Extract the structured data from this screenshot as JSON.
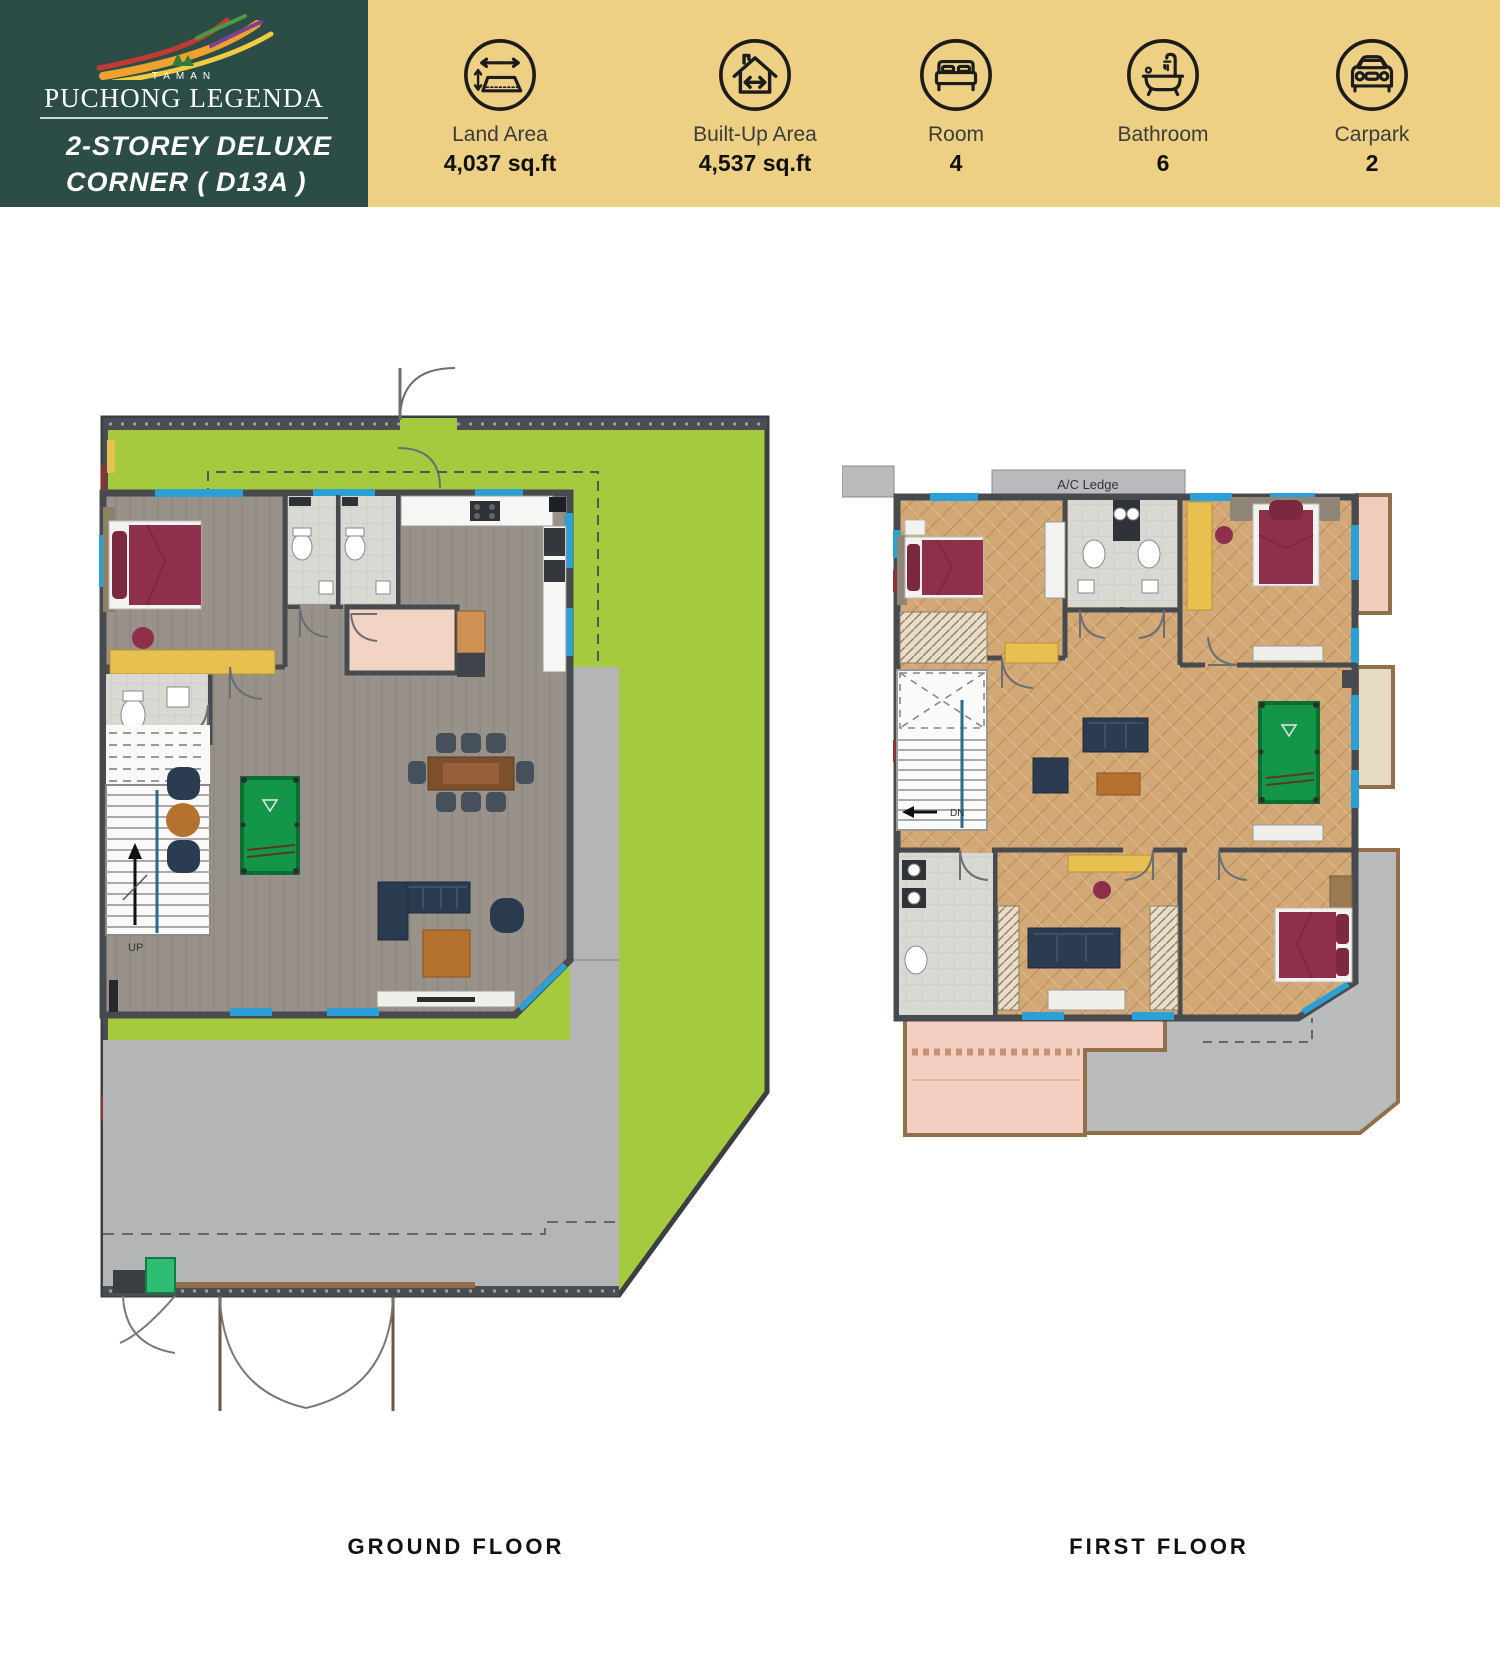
{
  "header": {
    "logo": {
      "tagline": "TAMAN",
      "brand": "PUCHONG LEGENDA"
    },
    "title_line1": "2-STOREY DELUXE",
    "title_line2": "CORNER ( D13A )",
    "stats": [
      {
        "icon": "land-area-icon",
        "label": "Land Area",
        "value": "4,037 sq.ft"
      },
      {
        "icon": "built-up-area-icon",
        "label": "Built-Up Area",
        "value": "4,537 sq.ft"
      },
      {
        "icon": "bed-icon",
        "label": "Room",
        "value": "4"
      },
      {
        "icon": "bathtub-icon",
        "label": "Bathroom",
        "value": "6"
      },
      {
        "icon": "car-icon",
        "label": "Carpark",
        "value": "2"
      }
    ]
  },
  "colors": {
    "header_panel": "#2b4d45",
    "banner": "#edd083",
    "lawn": "#a5ca3e",
    "wall": "#474b4f",
    "driveway": "#b3b5b7",
    "window_blue": "#2aa0d6",
    "accent_maroon": "#8e2f4b",
    "pool_green": "#14964a"
  },
  "plans": {
    "ground": {
      "caption": "GROUND FLOOR",
      "stair_label": "UP"
    },
    "first": {
      "caption": "FIRST FLOOR",
      "stair_label": "DN",
      "ac_ledge_label": "A/C Ledge"
    }
  }
}
